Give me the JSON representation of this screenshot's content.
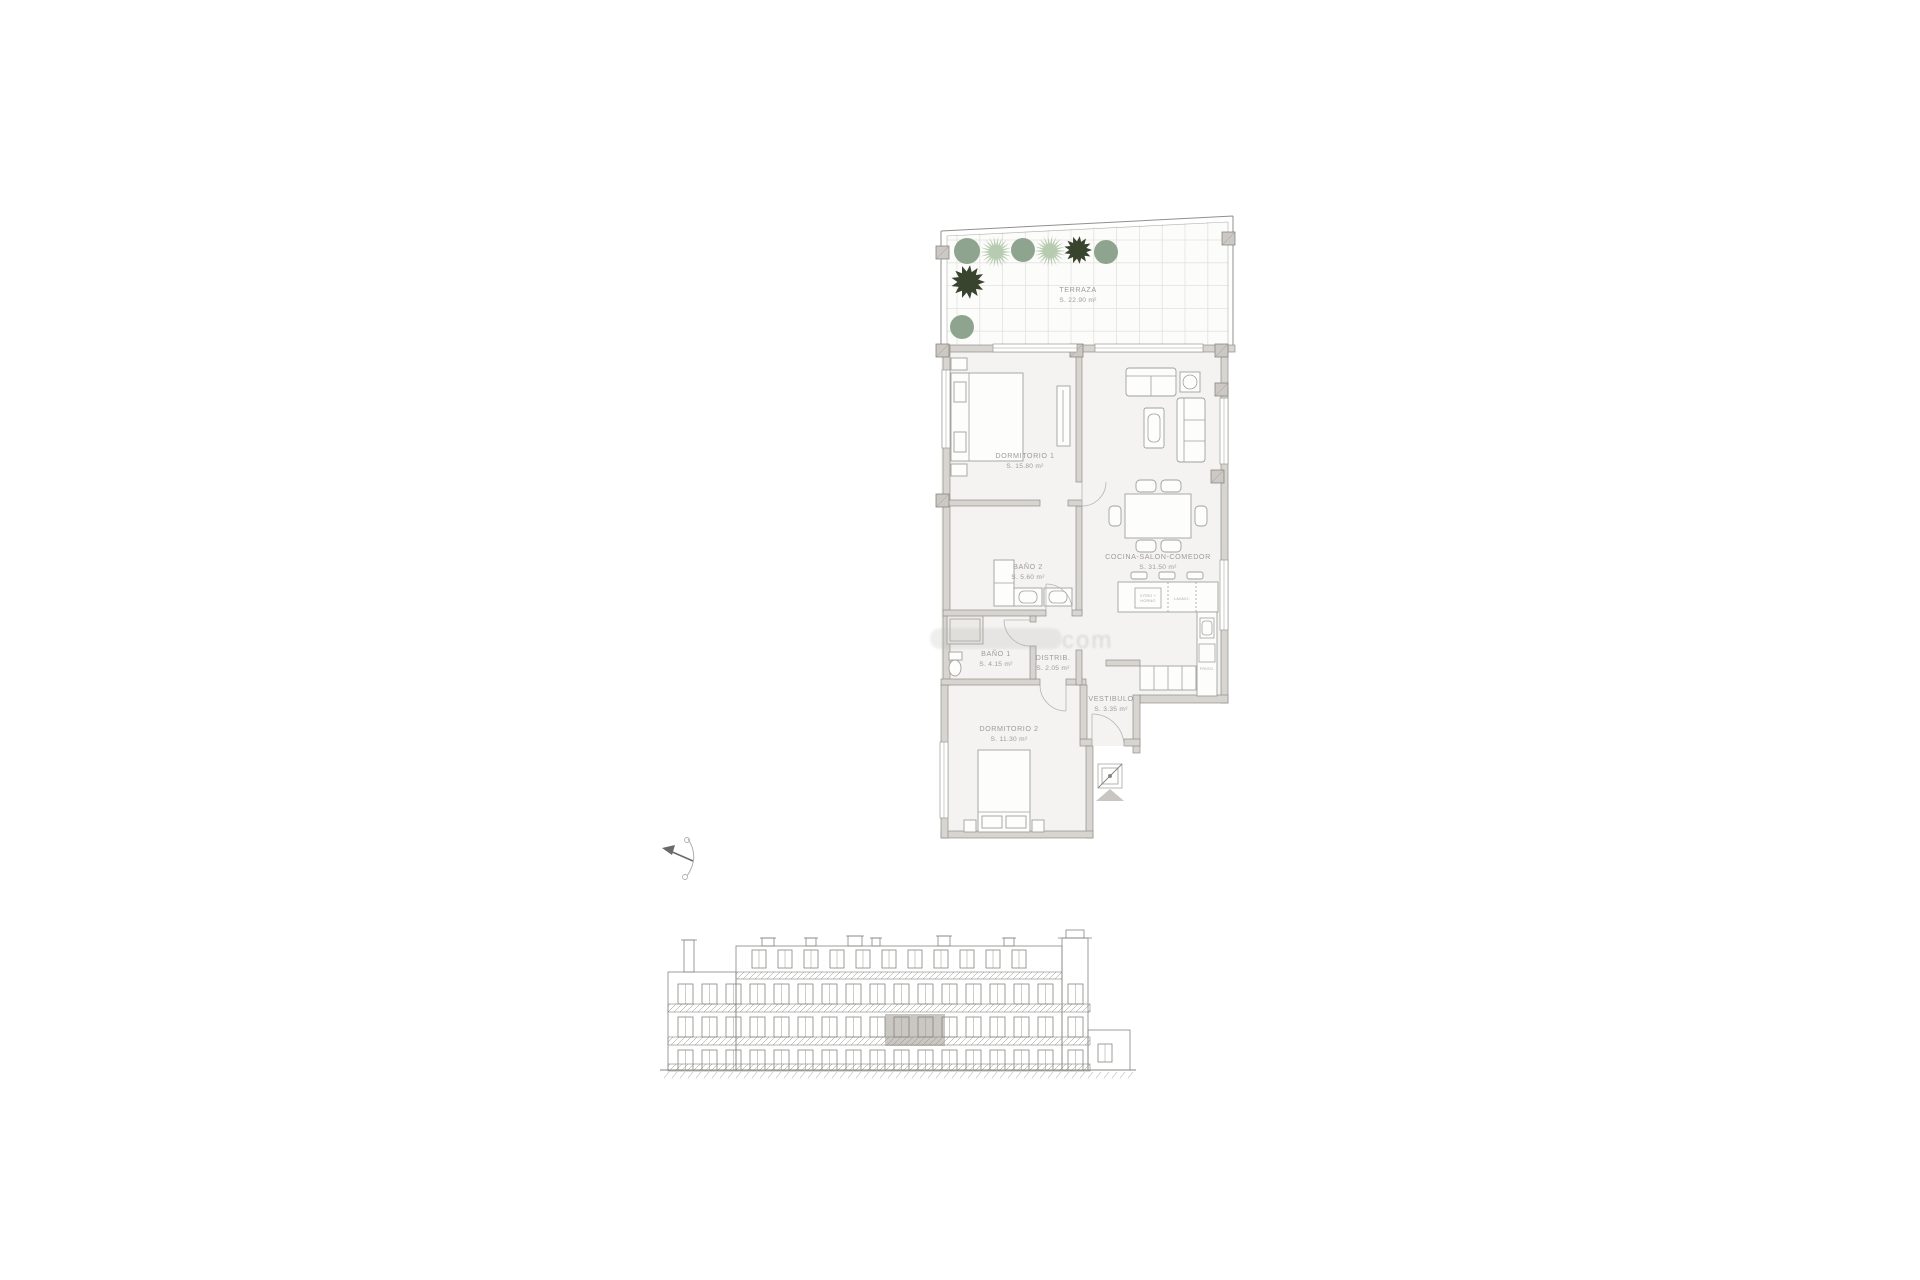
{
  "document": {
    "type": "apartment-floor-plan-with-elevation",
    "background": "#ffffff"
  },
  "floorplan": {
    "rooms": [
      {
        "id": "terraza",
        "name": "TERRAZA",
        "area": "S. 22.90 m²"
      },
      {
        "id": "dormitorio1",
        "name": "DORMITORIO 1",
        "area": "S. 15.80 m²"
      },
      {
        "id": "cocina_salon",
        "name": "COCINA-SALON-COMEDOR",
        "area": "S. 31.50 m²"
      },
      {
        "id": "bano2",
        "name": "BAÑO 2",
        "area": "S. 5.60 m²"
      },
      {
        "id": "bano1",
        "name": "BAÑO 1",
        "area": "S. 4.15 m²"
      },
      {
        "id": "distribuidor",
        "name": "DISTRIB.",
        "area": "S. 2.05 m²"
      },
      {
        "id": "vestibulo",
        "name": "VESTIBULO",
        "area": "S. 3.35 m²"
      },
      {
        "id": "dormitorio2",
        "name": "DORMITORIO 2",
        "area": "S. 11.30 m²"
      }
    ],
    "kitchen": {
      "hob_line1": "VITRO +",
      "hob_line2": "HORNO",
      "dishwasher": "LAVAVJ.",
      "fridge": "FRIGO."
    }
  },
  "watermark": {
    "text": "com"
  },
  "colors": {
    "wall": "#d8d5d0",
    "wall_stroke": "#8f8f8b",
    "floor": "#f4f3f1",
    "terrace_floor": "#fcfcfb",
    "grid": "#e4e2df",
    "label": "#9c9c99",
    "plant_sage": "#8fa48f",
    "plant_light": "#b6cbb0",
    "plant_dark": "#39442f",
    "highlight_unit": "#cac7c2",
    "elevation_line": "#85857f"
  }
}
